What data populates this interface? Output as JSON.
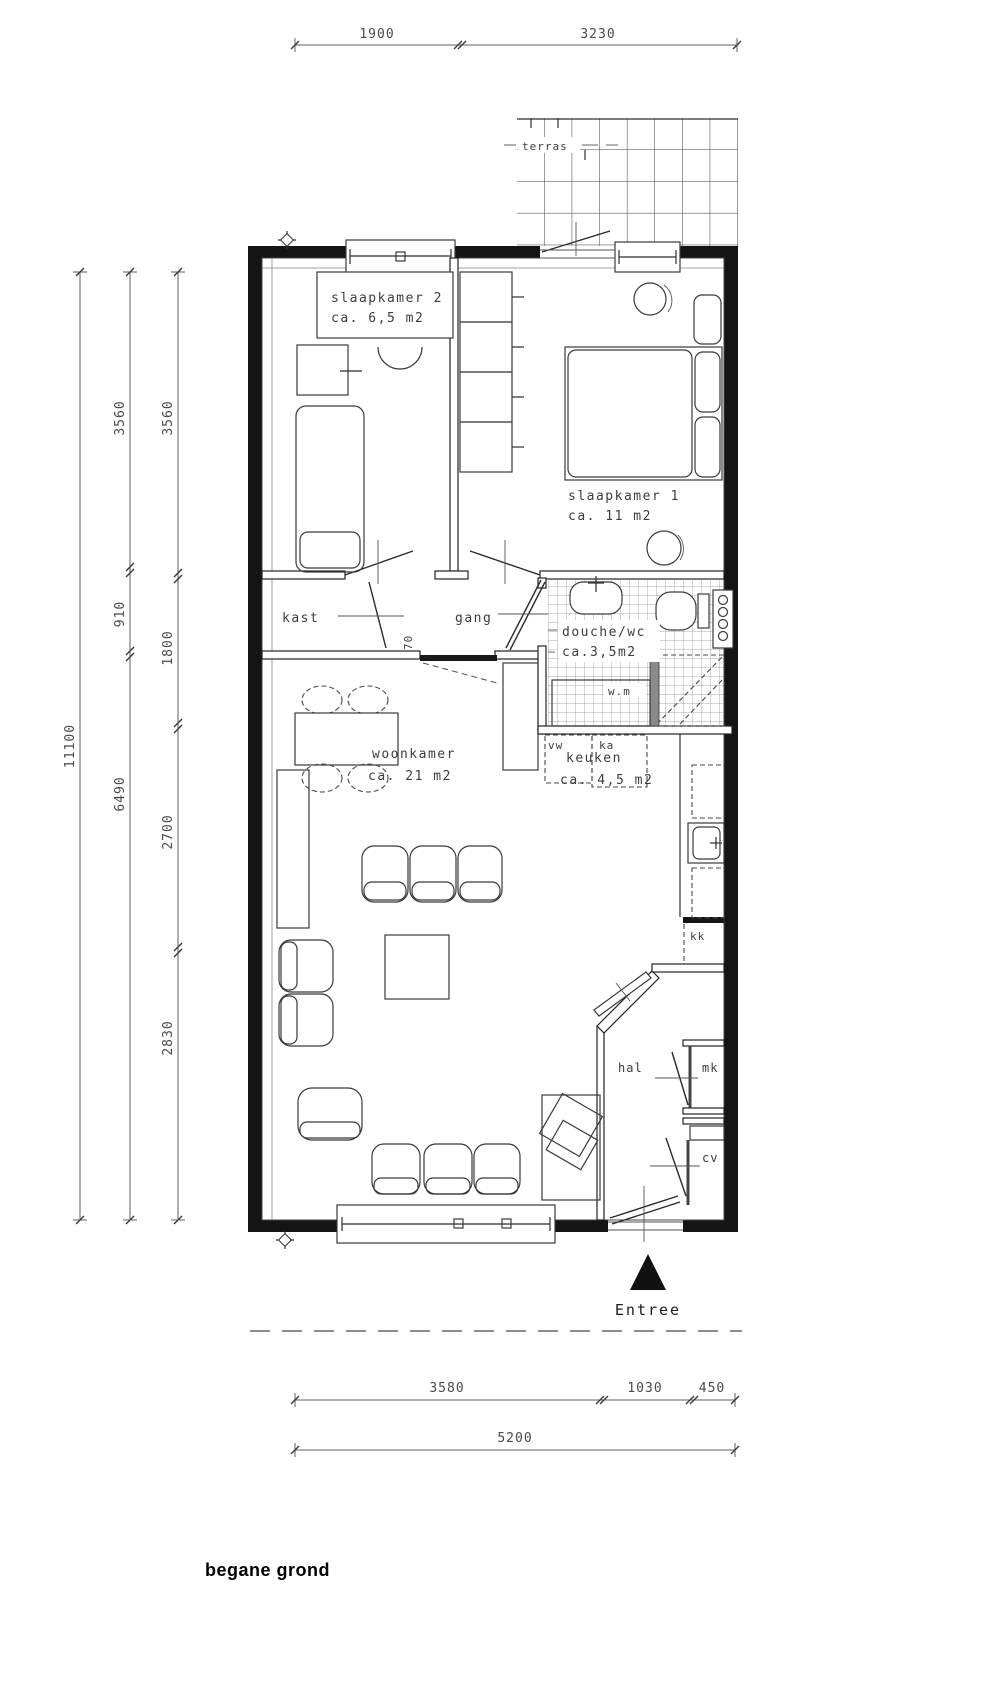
{
  "drawing": {
    "title": "begane grond"
  },
  "rooms": {
    "slaapkamer2": {
      "name": "slaapkamer 2",
      "area": "ca. 6,5 m2"
    },
    "slaapkamer1": {
      "name": "slaapkamer 1",
      "area": "ca. 11 m2"
    },
    "kast": {
      "name": "kast"
    },
    "gang": {
      "name": "gang"
    },
    "douche": {
      "name": "douche/wc",
      "area": "ca.3,5m2"
    },
    "woonkamer": {
      "name": "woonkamer",
      "area": "ca. 21 m2"
    },
    "keuken": {
      "name": "keuken",
      "area": "ca. 4,5 m2"
    },
    "hal": {
      "name": "hal"
    },
    "terras": {
      "name": "terras"
    }
  },
  "annotations": {
    "entree": "Entree",
    "wasmachine": "w.m",
    "vw": "vw",
    "ka": "ka",
    "kk": "kk",
    "mk": "mk",
    "cv": "cv",
    "door_width": "70"
  },
  "dimensions": {
    "top": [
      "1900",
      "3230"
    ],
    "left_total": "11100",
    "left_mid": [
      "3560",
      "910",
      "6490"
    ],
    "left_inner": [
      "3560",
      "1800",
      "2700",
      "2830"
    ],
    "bottom_inner": [
      "3580",
      "1030",
      "450"
    ],
    "bottom_total": "5200"
  },
  "colors": {
    "wall": "#141414",
    "line": "#2f2f2f",
    "dim": "#5f5f5f",
    "text": "#3d3d3d"
  }
}
